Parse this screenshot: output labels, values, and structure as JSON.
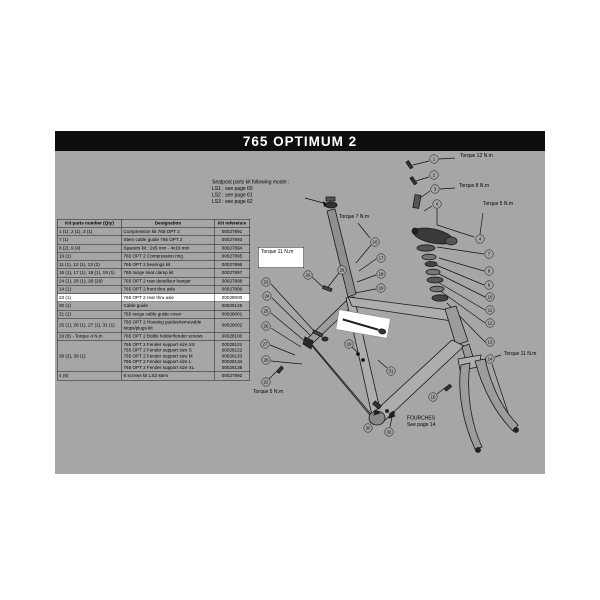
{
  "title": "765 OPTIMUM 2",
  "colors": {
    "panel_bg": "#a6a6a6",
    "title_bg": "#0e0e0e",
    "title_fg": "#ffffff",
    "row_highlight": "#ffffff",
    "line_art": "#1a1a1a"
  },
  "table": {
    "headers": [
      "Kit parts number (Qty)",
      "Designation",
      "Kit reference"
    ],
    "rows": [
      {
        "parts": "1 (1), 2 (1), 3 (1)",
        "designation": "Compression kit 765 OPT 2",
        "reference": "00027891",
        "highlight": false
      },
      {
        "parts": "7 (1)",
        "designation": "Stem cable guide 765 OPT 2",
        "reference": "00027893",
        "highlight": false
      },
      {
        "parts": "8 (2), 9 (4)",
        "designation": "Spacers kit : 2x5 mm - 4x10 mm",
        "reference": "00027894",
        "highlight": false
      },
      {
        "parts": "10 (1)",
        "designation": "765 OPT 2 Compression ring",
        "reference": "00027895",
        "highlight": false
      },
      {
        "parts": "11 (1), 12 (1), 13 (2)",
        "designation": "765 OPT 2 bearings kit",
        "reference": "00027896",
        "highlight": false
      },
      {
        "parts": "16 (1), 17 (1), 18 (1), 19 (1)",
        "designation": "765 range seat clamp kit",
        "reference": "00027897",
        "highlight": false
      },
      {
        "parts": "24 (1), 28 (1), 29 (29)",
        "designation": "765 OPT 2 rear derailleur hanger",
        "reference": "00027898",
        "highlight": false
      },
      {
        "parts": "14 (1)",
        "designation": "765 OPT 2 front thru axle",
        "reference": "00027899",
        "highlight": false
      },
      {
        "parts": "23 (1)",
        "designation": "765 OPT 2 rear thru axle",
        "reference": "00028000",
        "highlight": true
      },
      {
        "parts": "20 (1)",
        "designation": "Cable guide",
        "reference": "00025128",
        "highlight": false
      },
      {
        "parts": "21 (1)",
        "designation": "765 range cable guide cover",
        "reference": "00028001",
        "highlight": false
      },
      {
        "parts": "25 (1), 26 (1), 27 (1), 31 (1)",
        "designation": "765 OPT 2 Housing guides/removable\nstops/plugs kit",
        "reference": "00028002",
        "highlight": false
      },
      {
        "parts": "19 (8) - Torque 4 N.m",
        "designation": "765 OPT 2 Bottle holder/fender screws",
        "reference": "00028100",
        "highlight": false
      },
      {
        "parts": "39 (2), 38 (1)",
        "designation": "765 OPT 2 Fender support size XS\n765 OPT 2 Fender support size S\n765 OPT 2 Fender support size M\n765 OPT 2 Fender support size L\n765 OPT 2 Fender support size XL",
        "reference": "00028121\n00028122\n00028133\n00028134\n00028135",
        "highlight": false
      },
      {
        "parts": "4 (6)",
        "designation": "6 screws kit LS3 stem",
        "reference": "00027992",
        "highlight": false
      }
    ]
  },
  "notes": {
    "seatpost_kit": [
      "Seatpost parts kit following model :",
      "LS1 : see page 60",
      "LS2 : see page 61",
      "LS3 : see page 62"
    ],
    "fork": [
      "FOURCHES",
      "See page 14"
    ]
  },
  "torque_labels": [
    {
      "text": "Torque 12 N.m",
      "x": 405,
      "y": 2,
      "boxed": false
    },
    {
      "text": "Torque 8 N.m",
      "x": 404,
      "y": 32,
      "boxed": false
    },
    {
      "text": "Torque 5 N.m",
      "x": 428,
      "y": 50,
      "boxed": false
    },
    {
      "text": "Torque 7 N.m",
      "x": 284,
      "y": 63,
      "boxed": false
    },
    {
      "text": "Torque 11 N.m",
      "x": 203,
      "y": 96,
      "boxed": true
    },
    {
      "text": "Torque 11 N.m",
      "x": 449,
      "y": 200,
      "boxed": false
    },
    {
      "text": "Torque 5 N.m",
      "x": 198,
      "y": 238,
      "boxed": false
    }
  ],
  "callouts": [
    {
      "n": "1",
      "cx": 379,
      "cy": 8
    },
    {
      "n": "2",
      "cx": 379,
      "cy": 24
    },
    {
      "n": "3",
      "cx": 380,
      "cy": 38
    },
    {
      "n": "4",
      "cx": 382,
      "cy": 53
    },
    {
      "n": "4",
      "cx": 425,
      "cy": 88
    },
    {
      "n": "7",
      "cx": 434,
      "cy": 103
    },
    {
      "n": "8",
      "cx": 434,
      "cy": 120
    },
    {
      "n": "9",
      "cx": 434,
      "cy": 134
    },
    {
      "n": "10",
      "cx": 435,
      "cy": 146
    },
    {
      "n": "11",
      "cx": 435,
      "cy": 159
    },
    {
      "n": "12",
      "cx": 435,
      "cy": 172
    },
    {
      "n": "13",
      "cx": 435,
      "cy": 191
    },
    {
      "n": "14",
      "cx": 435,
      "cy": 208
    },
    {
      "n": "15",
      "cx": 378,
      "cy": 246
    },
    {
      "n": "16",
      "cx": 320,
      "cy": 91
    },
    {
      "n": "17",
      "cx": 326,
      "cy": 107
    },
    {
      "n": "18",
      "cx": 326,
      "cy": 123
    },
    {
      "n": "19",
      "cx": 326,
      "cy": 137
    },
    {
      "n": "19",
      "cx": 294,
      "cy": 193
    },
    {
      "n": "20",
      "cx": 253,
      "cy": 124
    },
    {
      "n": "29",
      "cx": 287,
      "cy": 119
    },
    {
      "n": "23",
      "cx": 211,
      "cy": 131
    },
    {
      "n": "24",
      "cx": 212,
      "cy": 145
    },
    {
      "n": "25",
      "cx": 211,
      "cy": 160
    },
    {
      "n": "26",
      "cx": 211,
      "cy": 175
    },
    {
      "n": "27",
      "cx": 210,
      "cy": 193
    },
    {
      "n": "28",
      "cx": 211,
      "cy": 209
    },
    {
      "n": "22",
      "cx": 211,
      "cy": 231
    },
    {
      "n": "31",
      "cx": 336,
      "cy": 220
    },
    {
      "n": "30",
      "cx": 313,
      "cy": 277
    },
    {
      "n": "32",
      "cx": 334,
      "cy": 281
    }
  ]
}
